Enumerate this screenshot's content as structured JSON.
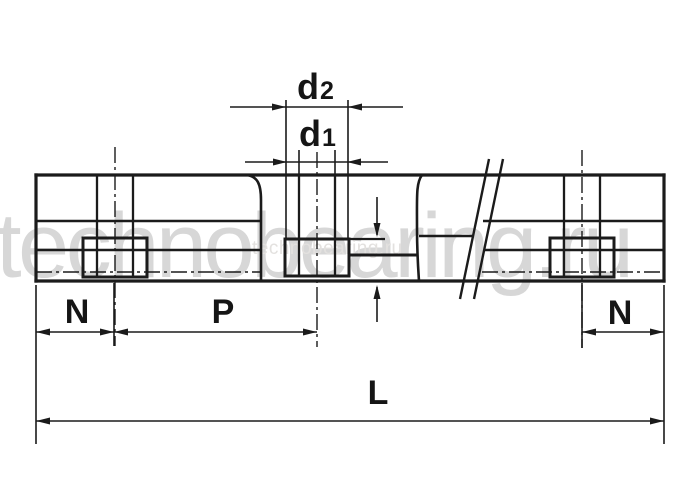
{
  "watermark": {
    "large_text": "technobearing.ru",
    "small_text": "technobearing.ru"
  },
  "labels": {
    "d2_base": "d",
    "d2_sub": "2",
    "d1_base": "d",
    "d1_sub": "1",
    "n_left": "N",
    "pitch": "P",
    "n_right": "N",
    "length": "L"
  },
  "colors": {
    "line": "#1b1b1b",
    "background": "#ffffff",
    "watermark": "#d7d7d7"
  },
  "drawing": {
    "subject": "linear guide rail side view with mounting hole dimensions",
    "dimension_names": [
      "d2",
      "d1",
      "N",
      "P",
      "N",
      "L"
    ]
  }
}
